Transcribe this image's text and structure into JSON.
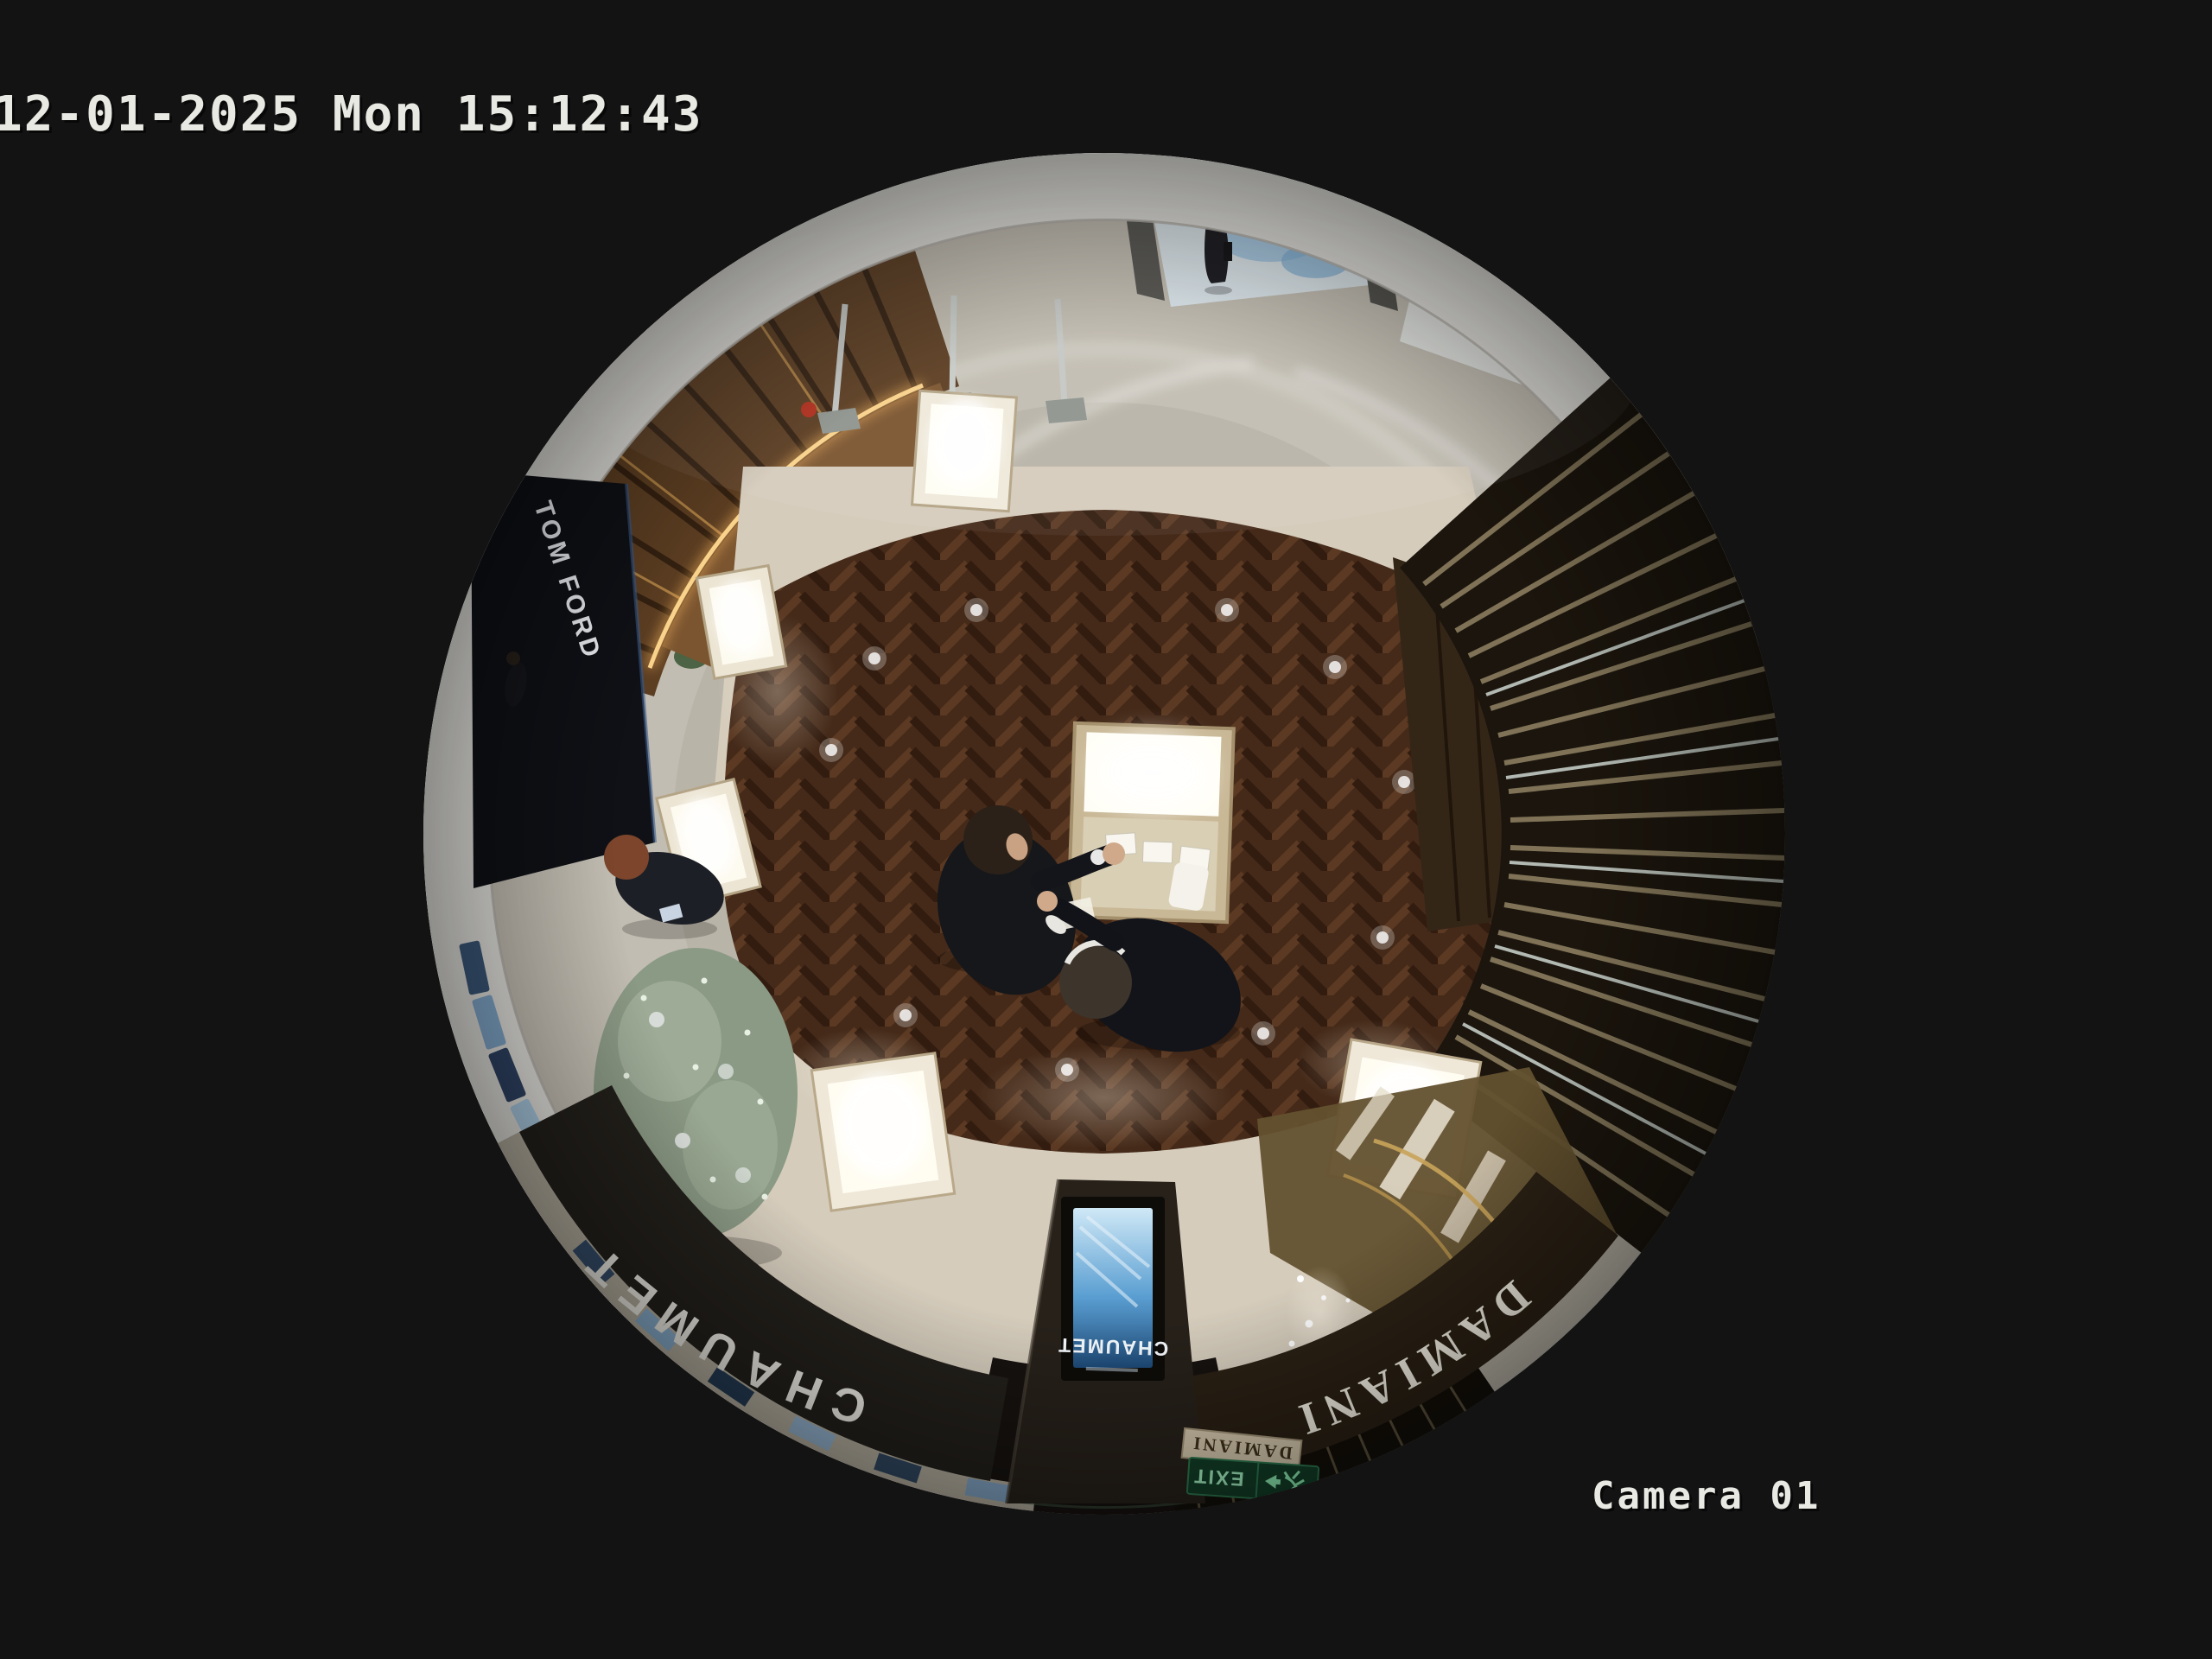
{
  "osd": {
    "timestamp": "12-01-2025 Mon 15:12:43",
    "camera_label": "Camera 01"
  },
  "scene": {
    "storefront_signs": {
      "tom_ford": "TOM FORD",
      "chaumet": "CHAUMET",
      "damiani": "DAMIANI"
    },
    "displays": {
      "chaumet_totem_screen": "CHAUMET",
      "damiani_counter_plate": "DAMIANI"
    },
    "exit_sign": {
      "label": "EXIT"
    },
    "colors": {
      "background": "#131313",
      "osd_text": "#e9e9e4",
      "white_rim": "#e6e5e0",
      "corridor_tile": "#c0bbb0",
      "wood_floor": "#452a19",
      "gold_trim": "#f2b05c",
      "exit_green": "#123f28",
      "exit_glyph_green": "#8ef0b4",
      "totem_screen_blue": "#5b9fd2"
    }
  }
}
